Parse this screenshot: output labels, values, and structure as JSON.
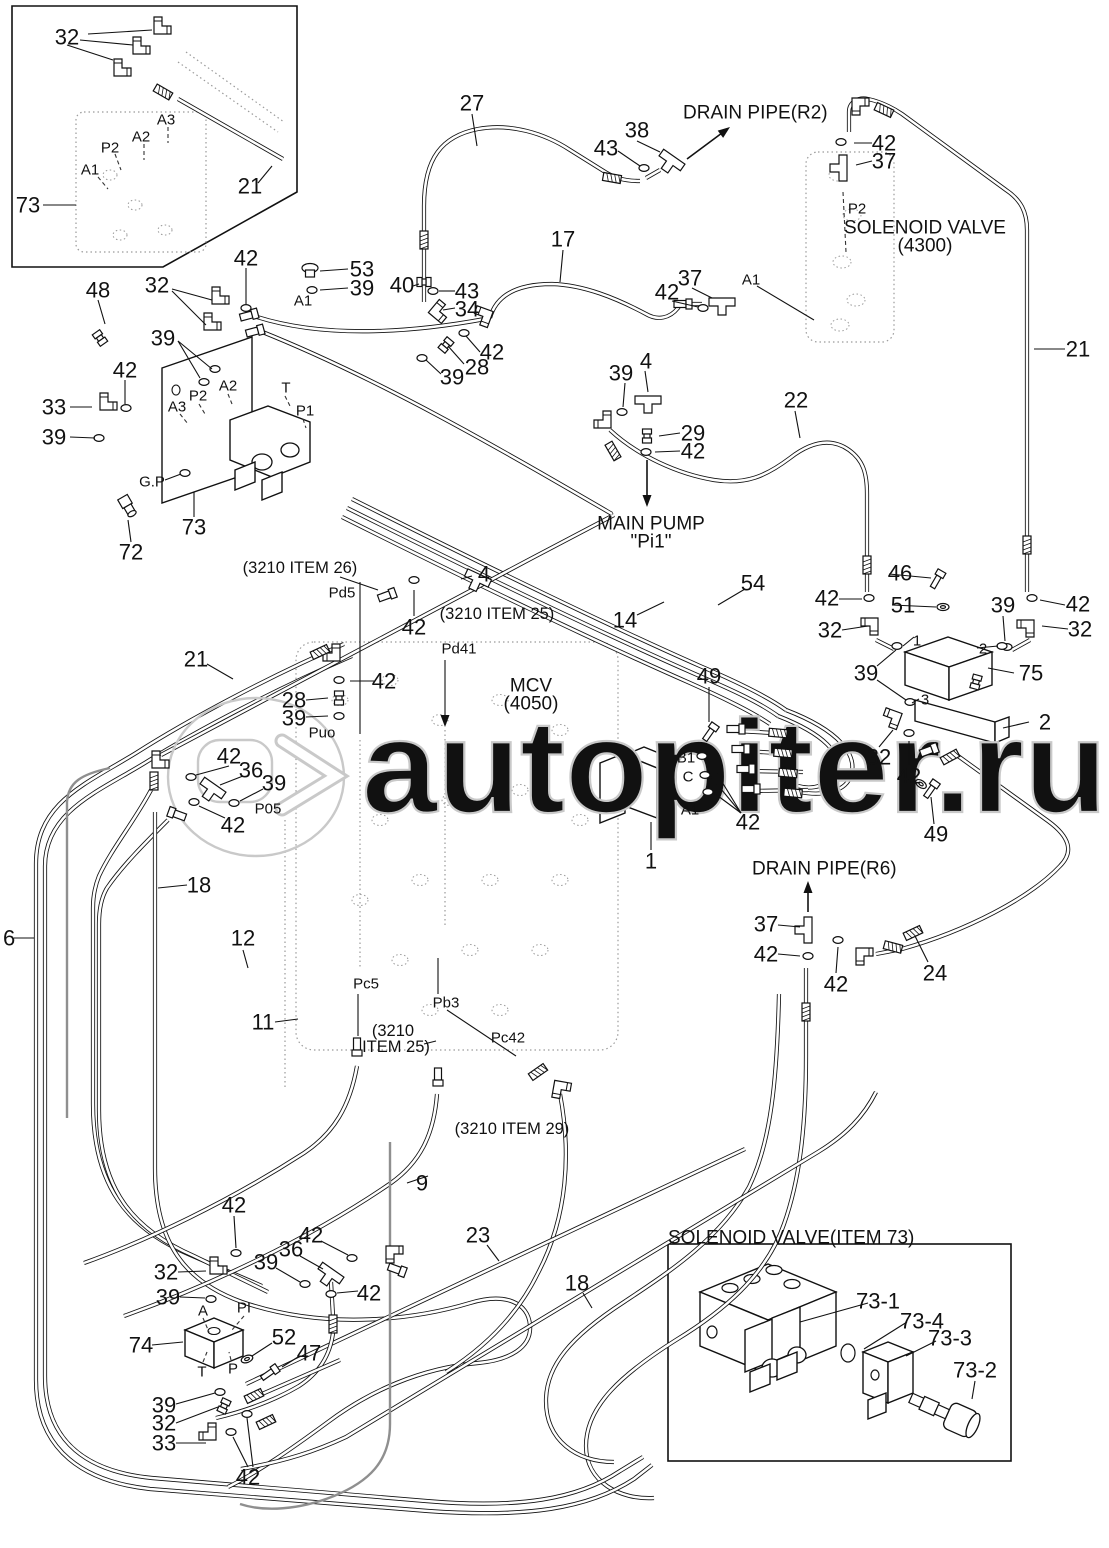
{
  "watermark": {
    "text": "autopiter.ru",
    "logo_glyph": ">",
    "color": "#c9c9c9"
  },
  "titles": {
    "inset_bottom_right": "SOLENOID VALVE(ITEM 73)"
  },
  "colors": {
    "line": "#111111",
    "dotted": "#9a9a9a",
    "gray_pipe": "#8f8f8f"
  },
  "callouts": [
    {
      "t": "32",
      "x": 67,
      "y": 37,
      "k": "n"
    },
    {
      "t": "A3",
      "x": 166,
      "y": 119,
      "k": "p"
    },
    {
      "t": "A2",
      "x": 141,
      "y": 136,
      "k": "p"
    },
    {
      "t": "P2",
      "x": 110,
      "y": 147,
      "k": "p"
    },
    {
      "t": "A1",
      "x": 90,
      "y": 169,
      "k": "p"
    },
    {
      "t": "21",
      "x": 250,
      "y": 186,
      "k": "n"
    },
    {
      "t": "73",
      "x": 28,
      "y": 205,
      "k": "n"
    },
    {
      "t": "27",
      "x": 472,
      "y": 103,
      "k": "n"
    },
    {
      "t": "38",
      "x": 637,
      "y": 130,
      "k": "n"
    },
    {
      "t": "43",
      "x": 606,
      "y": 148,
      "k": "n"
    },
    {
      "t": "DRAIN PIPE(R2)",
      "x": 683,
      "y": 112,
      "k": "b",
      "a": "s"
    },
    {
      "t": "42",
      "x": 884,
      "y": 143,
      "k": "n"
    },
    {
      "t": "37",
      "x": 884,
      "y": 161,
      "k": "n"
    },
    {
      "t": "P2",
      "x": 857,
      "y": 208,
      "k": "p"
    },
    {
      "t": "SOLENOID VALVE",
      "x": 925,
      "y": 227,
      "k": "b"
    },
    {
      "t": "(4300)",
      "x": 925,
      "y": 245,
      "k": "b"
    },
    {
      "t": "21",
      "x": 1078,
      "y": 349,
      "k": "n"
    },
    {
      "t": "17",
      "x": 563,
      "y": 239,
      "k": "n"
    },
    {
      "t": "40",
      "x": 402,
      "y": 285,
      "k": "n"
    },
    {
      "t": "43",
      "x": 467,
      "y": 291,
      "k": "n"
    },
    {
      "t": "34",
      "x": 467,
      "y": 309,
      "k": "n"
    },
    {
      "t": "42",
      "x": 492,
      "y": 352,
      "k": "n"
    },
    {
      "t": "28",
      "x": 477,
      "y": 367,
      "k": "n"
    },
    {
      "t": "39",
      "x": 452,
      "y": 377,
      "k": "n"
    },
    {
      "t": "42",
      "x": 667,
      "y": 292,
      "k": "n"
    },
    {
      "t": "37",
      "x": 690,
      "y": 278,
      "k": "n"
    },
    {
      "t": "A1",
      "x": 751,
      "y": 279,
      "k": "p"
    },
    {
      "t": "39",
      "x": 621,
      "y": 373,
      "k": "n"
    },
    {
      "t": "4",
      "x": 646,
      "y": 361,
      "k": "n"
    },
    {
      "t": "29",
      "x": 693,
      "y": 433,
      "k": "n"
    },
    {
      "t": "42",
      "x": 693,
      "y": 451,
      "k": "n"
    },
    {
      "t": "22",
      "x": 796,
      "y": 400,
      "k": "n"
    },
    {
      "t": "MAIN PUMP",
      "x": 651,
      "y": 523,
      "k": "b"
    },
    {
      "t": "\"Pi1\"",
      "x": 651,
      "y": 541,
      "k": "b"
    },
    {
      "t": "46",
      "x": 900,
      "y": 573,
      "k": "n"
    },
    {
      "t": "51",
      "x": 903,
      "y": 605,
      "k": "n"
    },
    {
      "t": "42",
      "x": 827,
      "y": 598,
      "k": "n"
    },
    {
      "t": "32",
      "x": 830,
      "y": 630,
      "k": "n"
    },
    {
      "t": "39",
      "x": 1003,
      "y": 605,
      "k": "n"
    },
    {
      "t": "42",
      "x": 1078,
      "y": 604,
      "k": "n"
    },
    {
      "t": "32",
      "x": 1080,
      "y": 629,
      "k": "n"
    },
    {
      "t": "39",
      "x": 866,
      "y": 673,
      "k": "n"
    },
    {
      "t": "1",
      "x": 917,
      "y": 640,
      "k": "p"
    },
    {
      "t": "2",
      "x": 983,
      "y": 648,
      "k": "p"
    },
    {
      "t": "3",
      "x": 925,
      "y": 699,
      "k": "p"
    },
    {
      "t": "75",
      "x": 1031,
      "y": 673,
      "k": "n"
    },
    {
      "t": "2",
      "x": 1045,
      "y": 722,
      "k": "n"
    },
    {
      "t": "32",
      "x": 879,
      "y": 757,
      "k": "n"
    },
    {
      "t": "42",
      "x": 909,
      "y": 776,
      "k": "n"
    },
    {
      "t": "49",
      "x": 936,
      "y": 834,
      "k": "n"
    },
    {
      "t": "54",
      "x": 753,
      "y": 583,
      "k": "n"
    },
    {
      "t": "14",
      "x": 625,
      "y": 620,
      "k": "n"
    },
    {
      "t": "49",
      "x": 709,
      "y": 676,
      "k": "n"
    },
    {
      "t": "B1",
      "x": 686,
      "y": 757,
      "k": "p"
    },
    {
      "t": "C",
      "x": 688,
      "y": 776,
      "k": "p"
    },
    {
      "t": "A1",
      "x": 690,
      "y": 809,
      "k": "p"
    },
    {
      "t": "42",
      "x": 748,
      "y": 822,
      "k": "n"
    },
    {
      "t": "1",
      "x": 651,
      "y": 861,
      "k": "n"
    },
    {
      "t": "DRAIN PIPE(R6)",
      "x": 752,
      "y": 868,
      "k": "b",
      "a": "s"
    },
    {
      "t": "37",
      "x": 766,
      "y": 924,
      "k": "n"
    },
    {
      "t": "42",
      "x": 766,
      "y": 954,
      "k": "n"
    },
    {
      "t": "42",
      "x": 836,
      "y": 984,
      "k": "n"
    },
    {
      "t": "24",
      "x": 935,
      "y": 973,
      "k": "n"
    },
    {
      "t": "(3210 ITEM 26)",
      "x": 300,
      "y": 567,
      "k": "t"
    },
    {
      "t": "Pd5",
      "x": 342,
      "y": 592,
      "k": "p"
    },
    {
      "t": "4",
      "x": 484,
      "y": 574,
      "k": "n"
    },
    {
      "t": "42",
      "x": 414,
      "y": 627,
      "k": "n"
    },
    {
      "t": "(3210 ITEM 25)",
      "x": 497,
      "y": 613,
      "k": "t"
    },
    {
      "t": "Pd41",
      "x": 459,
      "y": 648,
      "k": "p"
    },
    {
      "t": "MCV",
      "x": 531,
      "y": 685,
      "k": "b"
    },
    {
      "t": "(4050)",
      "x": 531,
      "y": 703,
      "k": "b"
    },
    {
      "t": "21",
      "x": 196,
      "y": 659,
      "k": "n"
    },
    {
      "t": "42",
      "x": 384,
      "y": 681,
      "k": "n"
    },
    {
      "t": "28",
      "x": 294,
      "y": 700,
      "k": "n"
    },
    {
      "t": "39",
      "x": 294,
      "y": 718,
      "k": "n"
    },
    {
      "t": "Puo",
      "x": 322,
      "y": 732,
      "k": "p"
    },
    {
      "t": "42",
      "x": 229,
      "y": 756,
      "k": "n"
    },
    {
      "t": "36",
      "x": 251,
      "y": 770,
      "k": "n"
    },
    {
      "t": "39",
      "x": 274,
      "y": 783,
      "k": "n"
    },
    {
      "t": "P05",
      "x": 268,
      "y": 808,
      "k": "p"
    },
    {
      "t": "42",
      "x": 233,
      "y": 825,
      "k": "n"
    },
    {
      "t": "48",
      "x": 98,
      "y": 290,
      "k": "n"
    },
    {
      "t": "32",
      "x": 157,
      "y": 285,
      "k": "n"
    },
    {
      "t": "42",
      "x": 246,
      "y": 258,
      "k": "n"
    },
    {
      "t": "53",
      "x": 362,
      "y": 269,
      "k": "n"
    },
    {
      "t": "39",
      "x": 362,
      "y": 288,
      "k": "n"
    },
    {
      "t": "A1",
      "x": 303,
      "y": 300,
      "k": "p"
    },
    {
      "t": "39",
      "x": 163,
      "y": 338,
      "k": "n"
    },
    {
      "t": "42",
      "x": 125,
      "y": 370,
      "k": "n"
    },
    {
      "t": "33",
      "x": 54,
      "y": 407,
      "k": "n"
    },
    {
      "t": "39",
      "x": 54,
      "y": 437,
      "k": "n"
    },
    {
      "t": "A3",
      "x": 177,
      "y": 406,
      "k": "p"
    },
    {
      "t": "P2",
      "x": 198,
      "y": 395,
      "k": "p"
    },
    {
      "t": "A2",
      "x": 228,
      "y": 385,
      "k": "p"
    },
    {
      "t": "T",
      "x": 286,
      "y": 387,
      "k": "p"
    },
    {
      "t": "P1",
      "x": 305,
      "y": 410,
      "k": "p"
    },
    {
      "t": "G.P",
      "x": 152,
      "y": 481,
      "k": "p"
    },
    {
      "t": "73",
      "x": 194,
      "y": 527,
      "k": "n"
    },
    {
      "t": "72",
      "x": 131,
      "y": 552,
      "k": "n"
    },
    {
      "t": "6",
      "x": 3,
      "y": 938,
      "k": "n",
      "a": "s"
    },
    {
      "t": "18",
      "x": 199,
      "y": 885,
      "k": "n"
    },
    {
      "t": "12",
      "x": 243,
      "y": 938,
      "k": "n"
    },
    {
      "t": "11",
      "x": 263,
      "y": 1022,
      "k": "n"
    },
    {
      "t": "Pc5",
      "x": 366,
      "y": 983,
      "k": "p"
    },
    {
      "t": "Pb3",
      "x": 446,
      "y": 1002,
      "k": "p"
    },
    {
      "t": "(3210",
      "x": 393,
      "y": 1030,
      "k": "t"
    },
    {
      "t": "ITEM 25)",
      "x": 396,
      "y": 1046,
      "k": "t"
    },
    {
      "t": "Pc42",
      "x": 508,
      "y": 1037,
      "k": "p"
    },
    {
      "t": "(3210 ITEM 29)",
      "x": 512,
      "y": 1128,
      "k": "t"
    },
    {
      "t": "9",
      "x": 422,
      "y": 1183,
      "k": "n"
    },
    {
      "t": "23",
      "x": 478,
      "y": 1235,
      "k": "n"
    },
    {
      "t": "18",
      "x": 577,
      "y": 1283,
      "k": "n"
    },
    {
      "t": "42",
      "x": 234,
      "y": 1205,
      "k": "n"
    },
    {
      "t": "32",
      "x": 166,
      "y": 1272,
      "k": "n"
    },
    {
      "t": "39",
      "x": 168,
      "y": 1297,
      "k": "n"
    },
    {
      "t": "A",
      "x": 203,
      "y": 1310,
      "k": "p"
    },
    {
      "t": "PI",
      "x": 244,
      "y": 1307,
      "k": "p"
    },
    {
      "t": "74",
      "x": 141,
      "y": 1345,
      "k": "n"
    },
    {
      "t": "T",
      "x": 202,
      "y": 1371,
      "k": "p"
    },
    {
      "t": "P",
      "x": 233,
      "y": 1368,
      "k": "p"
    },
    {
      "t": "52",
      "x": 284,
      "y": 1337,
      "k": "n"
    },
    {
      "t": "47",
      "x": 309,
      "y": 1353,
      "k": "n"
    },
    {
      "t": "36",
      "x": 291,
      "y": 1249,
      "k": "n"
    },
    {
      "t": "39",
      "x": 266,
      "y": 1262,
      "k": "n"
    },
    {
      "t": "42",
      "x": 311,
      "y": 1235,
      "k": "n"
    },
    {
      "t": "42",
      "x": 369,
      "y": 1293,
      "k": "n"
    },
    {
      "t": "39",
      "x": 164,
      "y": 1405,
      "k": "n"
    },
    {
      "t": "32",
      "x": 164,
      "y": 1423,
      "k": "n"
    },
    {
      "t": "33",
      "x": 164,
      "y": 1443,
      "k": "n"
    },
    {
      "t": "42",
      "x": 248,
      "y": 1477,
      "k": "n"
    },
    {
      "t": "SOLENOID VALVE(ITEM 73)",
      "x": 668,
      "y": 1237,
      "k": "b",
      "a": "s"
    },
    {
      "t": "73-1",
      "x": 878,
      "y": 1301,
      "k": "n"
    },
    {
      "t": "73-4",
      "x": 922,
      "y": 1321,
      "k": "n"
    },
    {
      "t": "73-3",
      "x": 950,
      "y": 1338,
      "k": "n"
    },
    {
      "t": "73-2",
      "x": 975,
      "y": 1370,
      "k": "n"
    }
  ]
}
